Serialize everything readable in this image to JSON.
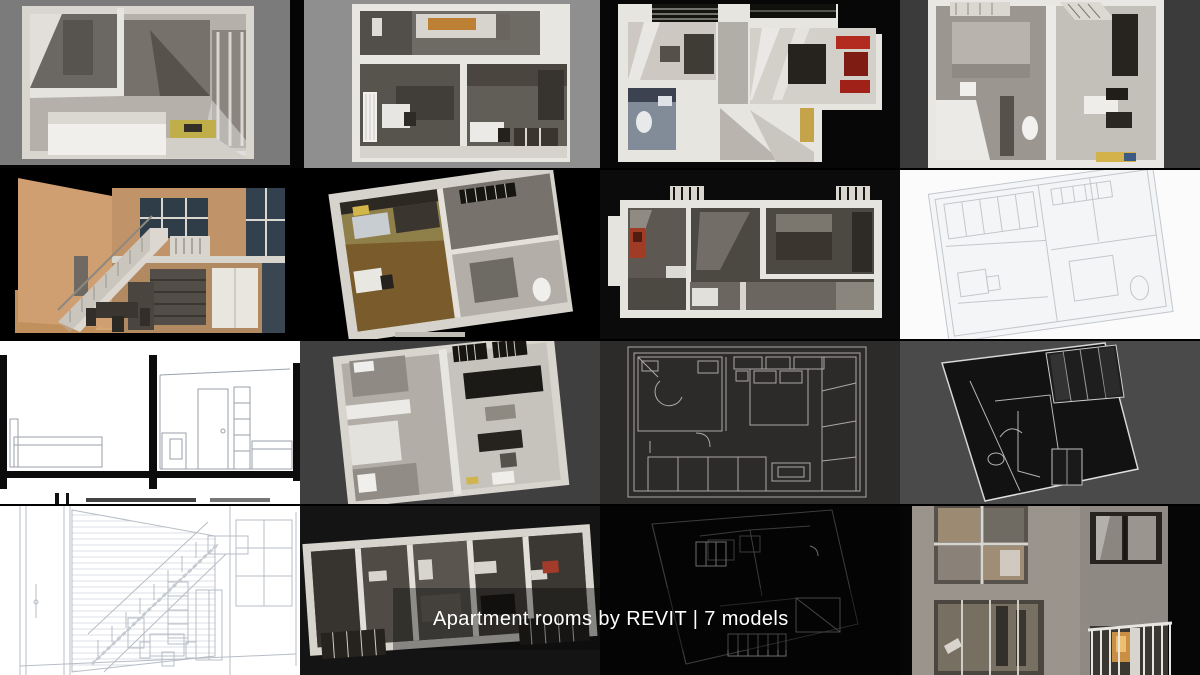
{
  "caption": {
    "text": "Apartment rooms by REVIT | 7 models",
    "color": "#ffffff"
  },
  "grid": {
    "rows": 4,
    "cols": 4
  },
  "tiles": [
    {
      "pos": "r1c1",
      "label": "shaded top-down studio room render",
      "backdrop": "#7b7b7b"
    },
    {
      "pos": "r1c2",
      "label": "shaded top-down apartment render with orange kitchen counter",
      "backdrop": "#8f8f8f"
    },
    {
      "pos": "r1c3",
      "label": "shaded top-down apartment render with red sofa",
      "backdrop": "#070707"
    },
    {
      "pos": "r1c4",
      "label": "shaded top-down two-room apartment render",
      "backdrop": "#3b3b3b"
    },
    {
      "pos": "r2c1",
      "label": "loft interior render with staircase and dining table",
      "backdrop": "#000000"
    },
    {
      "pos": "r2c2",
      "label": "isometric cutaway apartment render with olive walls",
      "backdrop": "#000000"
    },
    {
      "pos": "r2c3",
      "label": "wide top-down apartment render with red cabinet",
      "backdrop": "#0b0b0b"
    },
    {
      "pos": "r2c4",
      "label": "white hidden-line isometric apartment drawing",
      "backdrop": "#fbfbfb"
    },
    {
      "pos": "r3c1",
      "label": "black-and-white section drawing of bedroom and study",
      "backdrop": "#ffffff"
    },
    {
      "pos": "r3c2",
      "label": "isometric cutaway one-bed apartment render with black sofa",
      "backdrop": "#3f3f3f"
    },
    {
      "pos": "r3c3",
      "label": "dark wireframe top-down room drawing",
      "backdrop": "#2d2a2a"
    },
    {
      "pos": "r3c4",
      "label": "dark wireframe isometric room render with window grid",
      "backdrop": "#4a4a4a"
    },
    {
      "pos": "r4c1",
      "label": "white line-art loft interior with staircase and brick wall",
      "backdrop": "#ffffff"
    },
    {
      "pos": "r4c2",
      "label": "wide isometric cutaway apartment render",
      "backdrop": "#141414"
    },
    {
      "pos": "r4c3",
      "label": "black wireframe isometric apartment drawing",
      "backdrop": "#040404"
    },
    {
      "pos": "r4c4",
      "label": "building facade render with balcony and warm window glow",
      "backdrop": "#9a948d"
    }
  ],
  "accents": {
    "caption_white": "#ffffff",
    "wood_tan": "#c0915d",
    "olive_wall": "#8f7f49",
    "red_sofa": "#b32a1e",
    "yellow_table": "#c2b049",
    "orange_counter": "#bd7f33",
    "balcony_glow": "#edbf72"
  }
}
